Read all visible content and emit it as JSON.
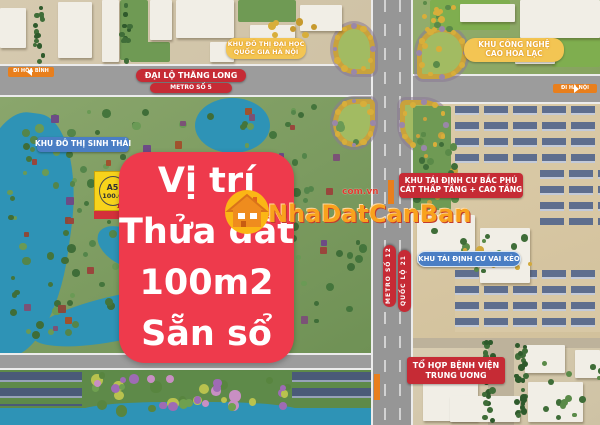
{
  "overlay": {
    "line1": "Vị trí",
    "line2": "Thửa đất",
    "line3": "100m2",
    "line4": "Sẵn sổ"
  },
  "map_labels": {
    "di_hoa_binh": "ĐI HÒA BÌNH",
    "dai_lo_thang_long": "ĐẠI LỘ THĂNG LONG",
    "metro_so_5": "METRO SỐ 5",
    "university_line1": "KHU ĐÔ THỊ ĐẠI HỌC",
    "university_line2": "QUỐC GIA HÀ NỘI",
    "tech_park_line1": "KHU CÔNG NGHỆ",
    "tech_park_line2": "CAO HÒA LẠC",
    "di_ha_noi": "ĐI HÀ NỘI",
    "eco_urban": "KHU ĐÔ THỊ SINH THÁI",
    "bac_phu_cat_line1": "KHU TÁI ĐỊNH CƯ BẮC PHÚ",
    "bac_phu_cat_line2": "CÁT THẤP TẦNG + CAO TẦNG",
    "vai_keo": "KHU TÁI ĐỊNH CƯ VAI KÈO",
    "metro_so_12": "METRO SỐ 12",
    "quoc_lo_21": "QUỐC LỘ 21",
    "hospital_line1": "TỔ HỢP BỆNH VIỆN",
    "hospital_line2": "TRUNG ƯƠNG"
  },
  "plot_marker": {
    "code": "A5",
    "area": "100.0",
    "sub": "11.0"
  },
  "watermark": {
    "brand": "NhaDatCanBan",
    "domain": "com.vn"
  },
  "colors": {
    "overlay_red": "#ee3a4c",
    "badge_red": "#c62b35",
    "badge_blue": "#4a7ec4",
    "badge_yellow": "#f3c553",
    "badge_orange": "#e87f1d",
    "water": "#2e93b6",
    "road": "#9c9c9c",
    "marker_yellow": "#f7d31b",
    "brand_orange": "#f9a21d"
  }
}
